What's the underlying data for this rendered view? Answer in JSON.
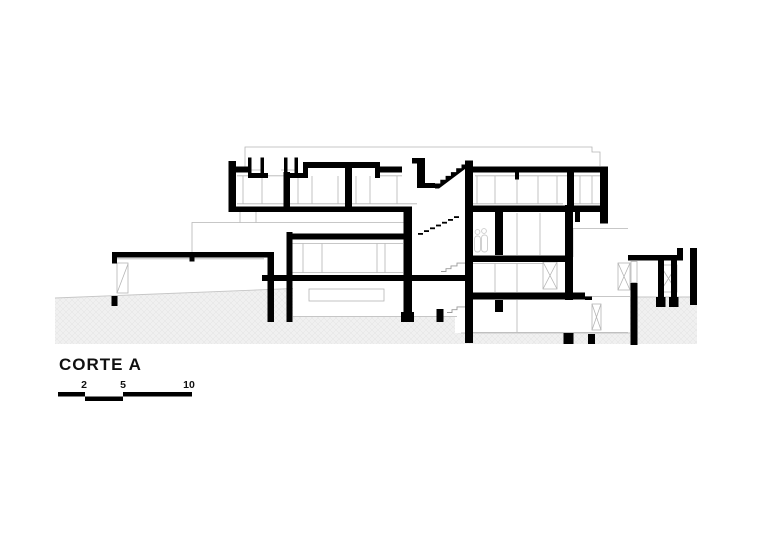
{
  "drawing": {
    "title": "CORTE A",
    "scale_bar": {
      "labels": [
        "2",
        "5",
        "10"
      ]
    },
    "colors": {
      "cut_black": "#000000",
      "detail_gray": "#b5b5b5",
      "terrain_fill": "#f0f0f0",
      "terrain_hatch": "#e0e0e0",
      "background": "#ffffff"
    }
  }
}
